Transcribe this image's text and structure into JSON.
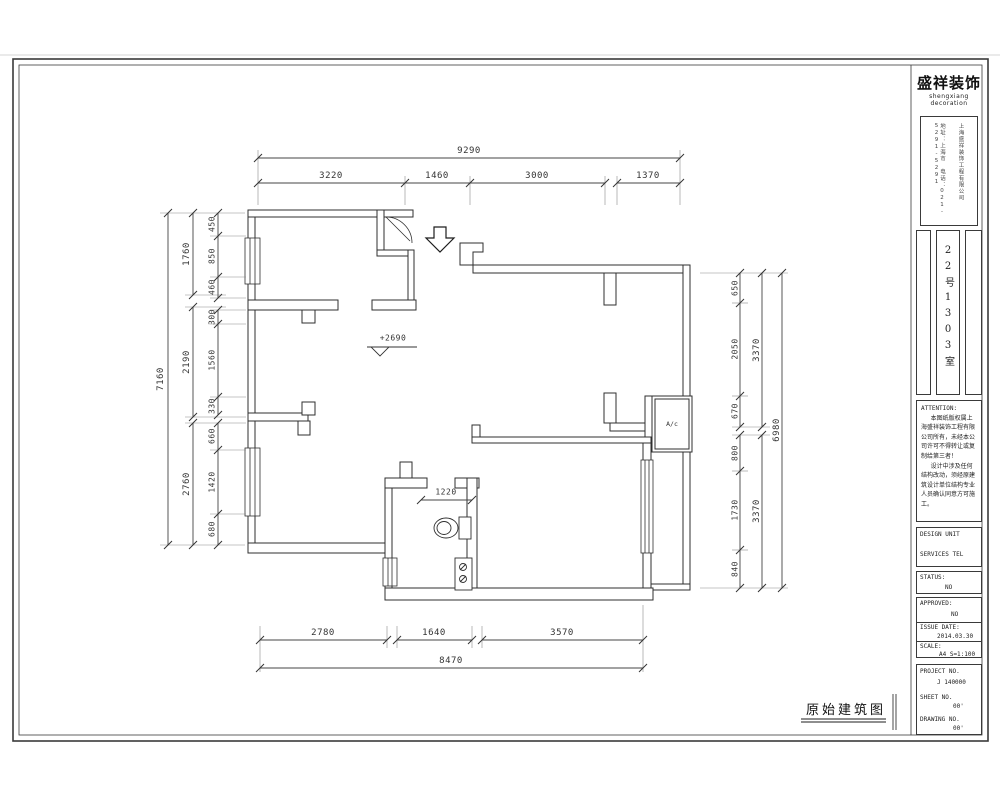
{
  "brand": {
    "cn": "盛祥装饰",
    "en": "shengxiang decoration"
  },
  "company_box": {
    "line1": "上海盛祥装饰工程有限公司",
    "line2": "地址：上海市　电话：021-5291-5291"
  },
  "room_label": "22号1303室",
  "attention": {
    "title": "ATTENTION:",
    "p1": "本图纸版权属上海盛祥装饰工程有限公司所有，未经本公司许可不得转让或复制给第三者！",
    "p2": "设计中涉及任何结构改动，须经原建筑设计单位结构专业人员确认同意方可施工。"
  },
  "fields": {
    "design_unit_label": "DESIGN UNIT",
    "design_unit_value": "SERVICES TEL",
    "status_label": "STATUS:",
    "status_value": "NO",
    "approved_label": "APPROVED:",
    "approved_value": "NO",
    "issue_date_label": "ISSUE DATE:",
    "issue_date_value": "2014.03.30",
    "scale_label": "SCALE:",
    "scale_value": "A4  S=1:100",
    "project_no_label": "PROJECT NO.",
    "project_no_value": "J 140000",
    "sheet_no_label": "SHEET NO.",
    "sheet_no_value": "00'",
    "drawing_no_label": "DRAWING NO.",
    "drawing_no_value": "00'"
  },
  "drawing_title": "原始建筑图",
  "plan": {
    "ac_label": "A/c",
    "level_marker": "+2690",
    "dims": {
      "top_total": "9290",
      "top": [
        "3220",
        "1460",
        "3000",
        "1370"
      ],
      "bottom": [
        "2780",
        "1640",
        "3570"
      ],
      "bottom_total": "8470",
      "left_outer": "7160",
      "left_mid": [
        "1760",
        "2190",
        "2760"
      ],
      "left_inner": [
        "450",
        "850",
        "460",
        "300",
        "1560",
        "330",
        "660",
        "1420",
        "680"
      ],
      "right_inner": [
        "650",
        "2050",
        "670",
        "800",
        "1730",
        "840"
      ],
      "right_mid": [
        "3370",
        "3370"
      ],
      "right_outer": "6980",
      "bath_width": "1220"
    }
  }
}
